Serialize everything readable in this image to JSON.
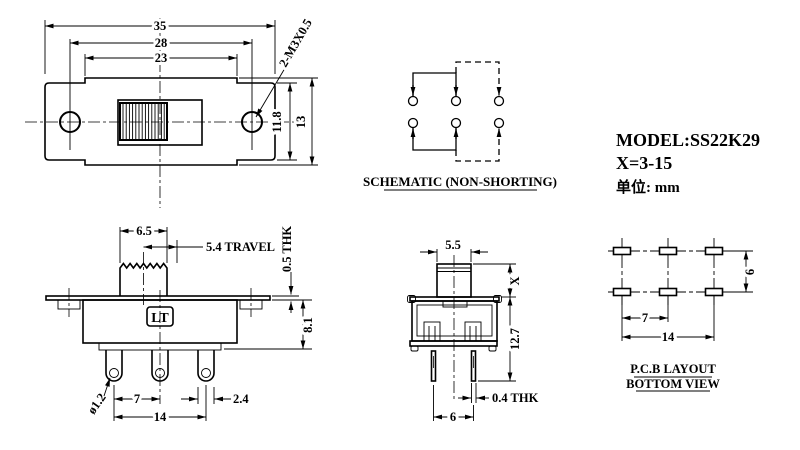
{
  "colors": {
    "line": "#000000",
    "background": "#ffffff"
  },
  "title_block": {
    "model": "MODEL:SS22K29",
    "x_range": "X=3-15",
    "unit": "单位: mm"
  },
  "front_view": {
    "dim_overall_width": "35",
    "dim_hole_spacing": "28",
    "dim_slot_span": "23",
    "thread_callout": "2-M3X0.5",
    "dim_inner_height": "11.8",
    "dim_overall_height": "13"
  },
  "schematic": {
    "caption": "SCHEMATIC (NON-SHORTING)"
  },
  "side_view": {
    "dim_knob_width": "6.5",
    "dim_travel": "5.4 TRAVEL",
    "dim_plate_thickness": "0.5 THK",
    "dim_body_height": "8.1",
    "logo": "LT",
    "dim_hole_diameter": "ø1.2",
    "dim_terminal_pitch": "7",
    "dim_terminal_span": "14",
    "dim_terminal_width": "2.4"
  },
  "end_view": {
    "dim_knob_width": "5.5",
    "dim_knob_height": "X",
    "dim_body_height": "12.7",
    "dim_pin_thickness": "0.4 THK",
    "dim_pin_spacing": "6"
  },
  "pcb_layout": {
    "dim_pad_pitch": "7",
    "dim_pad_span": "14",
    "dim_row_spacing": "6",
    "caption_line1": "P.C.B LAYOUT",
    "caption_line2": "BOTTOM VIEW"
  }
}
